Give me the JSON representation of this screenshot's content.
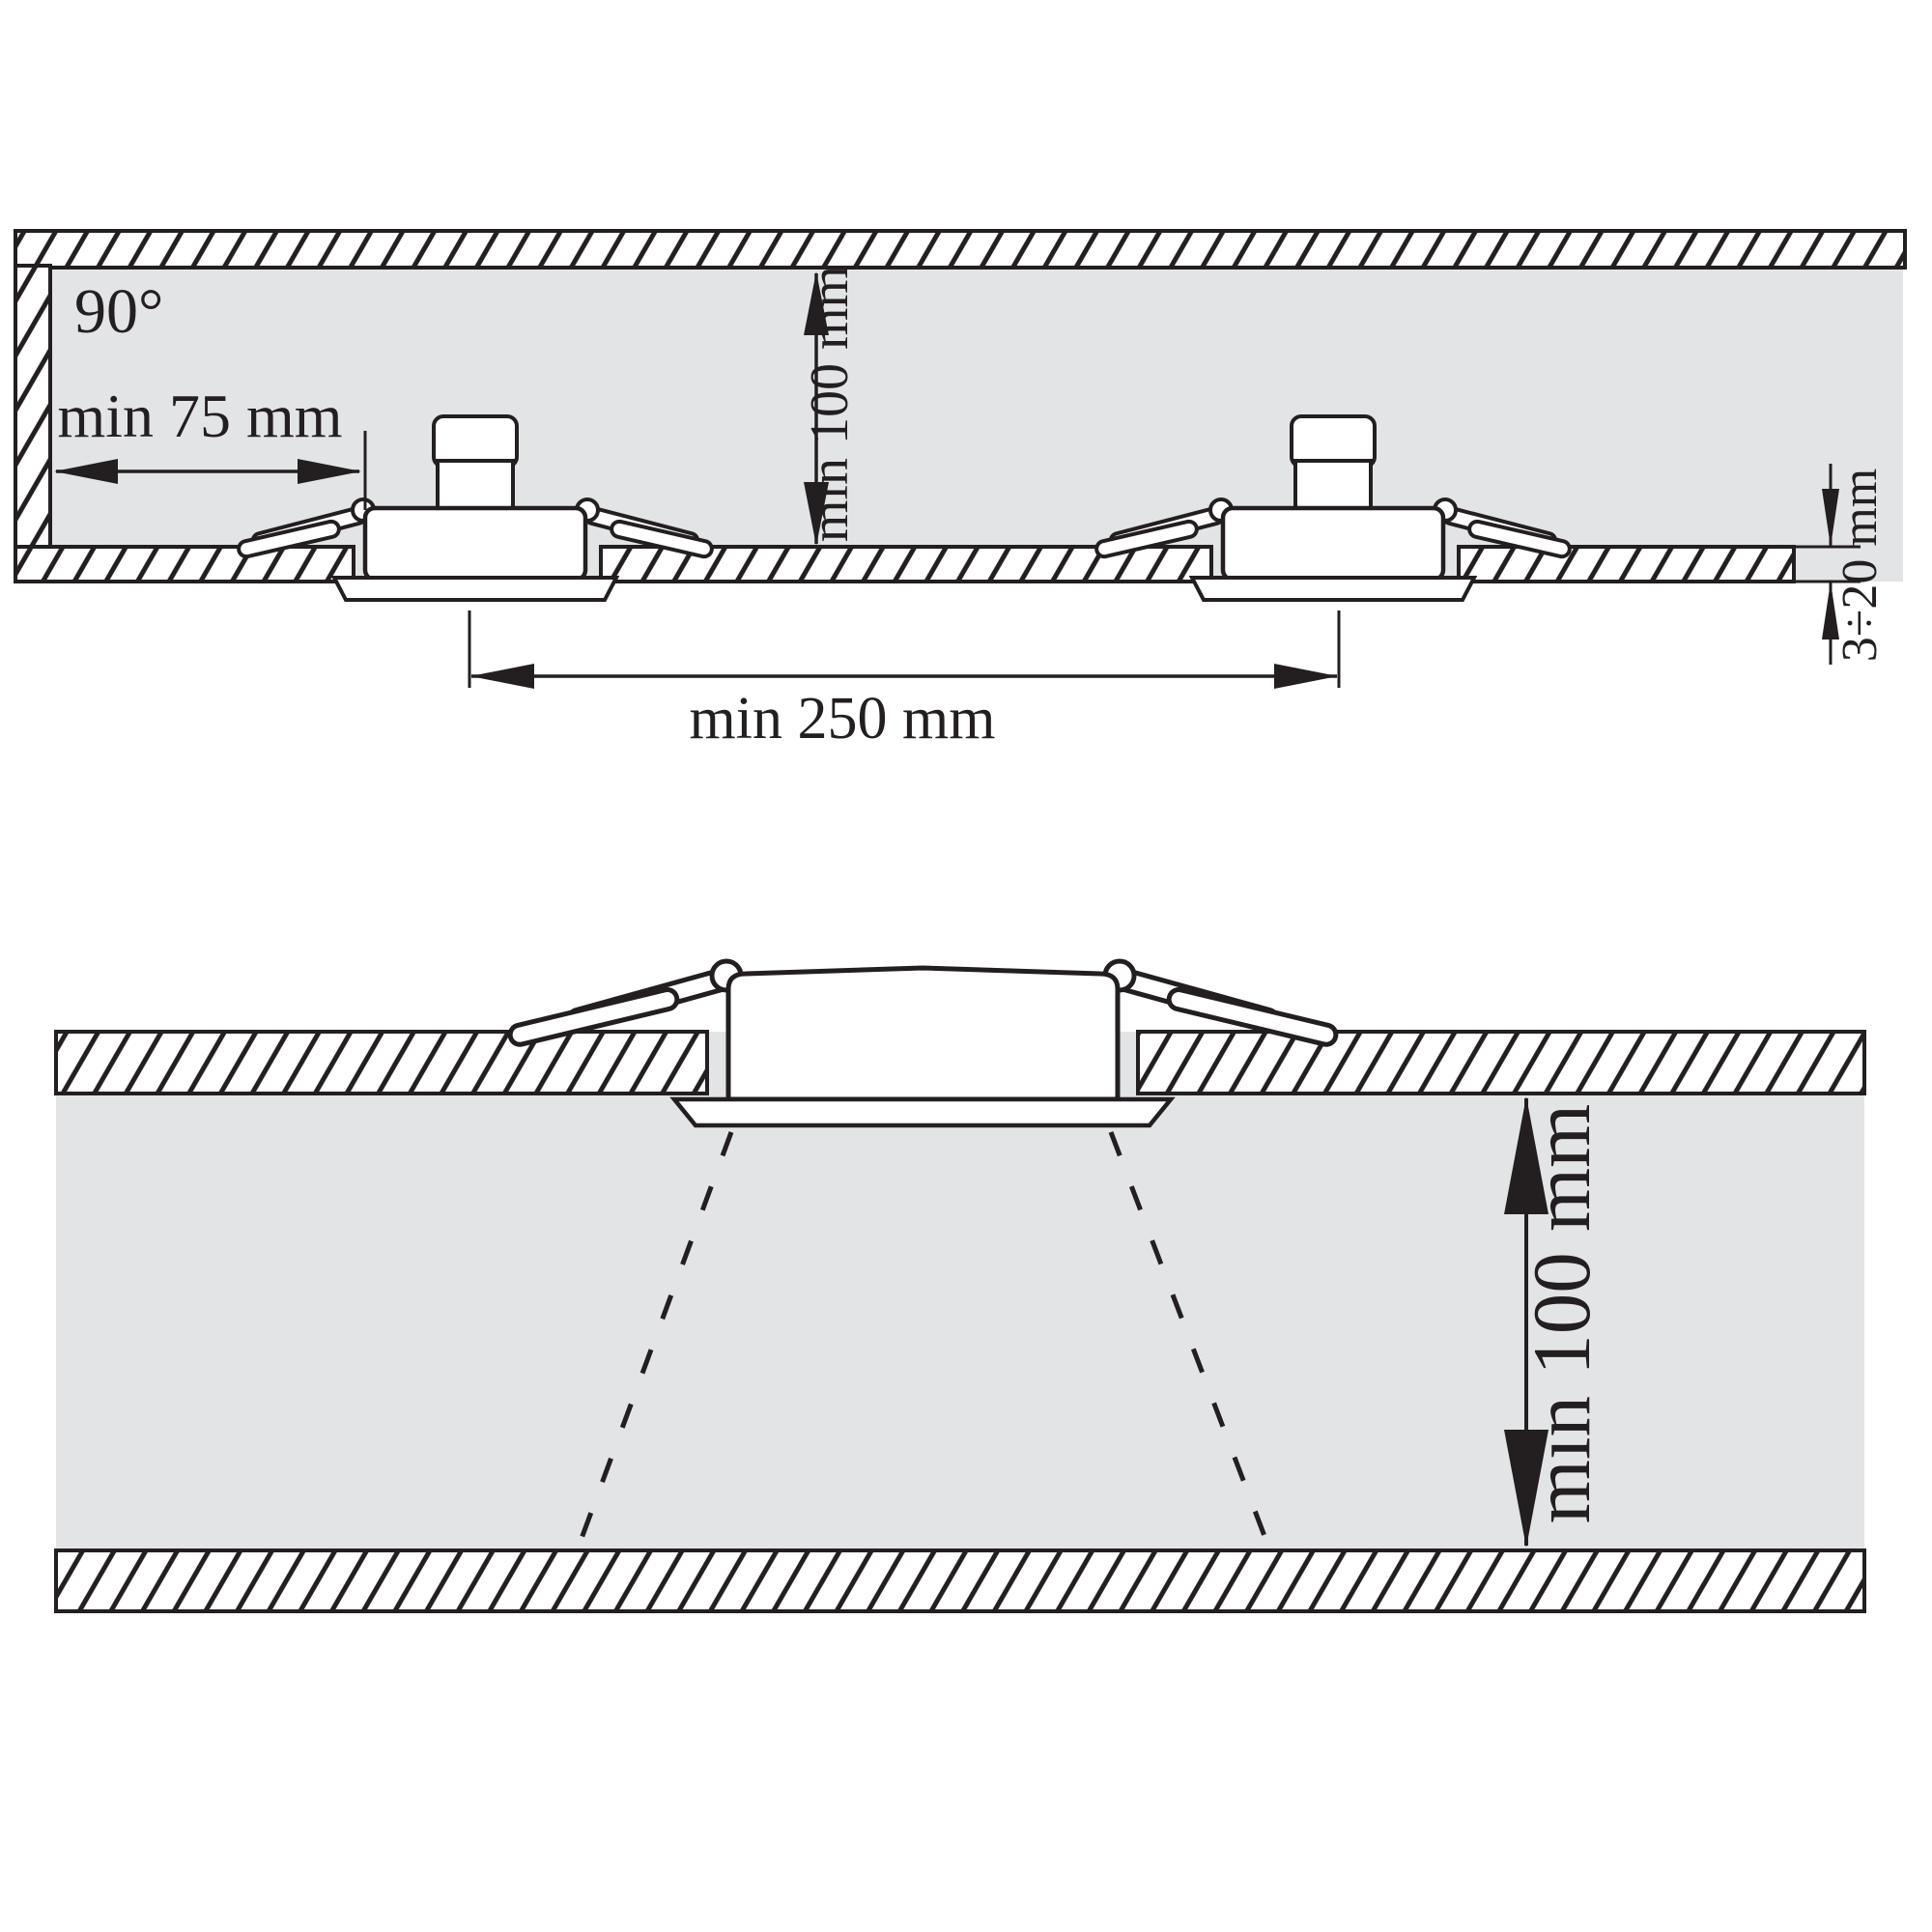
{
  "figure": {
    "description": "Installation clearance diagram for recessed ceiling downlights",
    "colors": {
      "line": "#231f20",
      "cavity_gray": "#e3e4e6",
      "fixture_white": "#ffffff"
    },
    "top_diagram": {
      "labels": {
        "beam_angle": "90°",
        "wall_clearance": "min 75 mm",
        "vertical_clearance": "min 100 mm",
        "panel_thickness": "3÷20 mm",
        "fixture_spacing": "min 250 mm"
      }
    },
    "bottom_diagram": {
      "labels": {
        "front_clearance": "min 100 mm"
      }
    }
  }
}
